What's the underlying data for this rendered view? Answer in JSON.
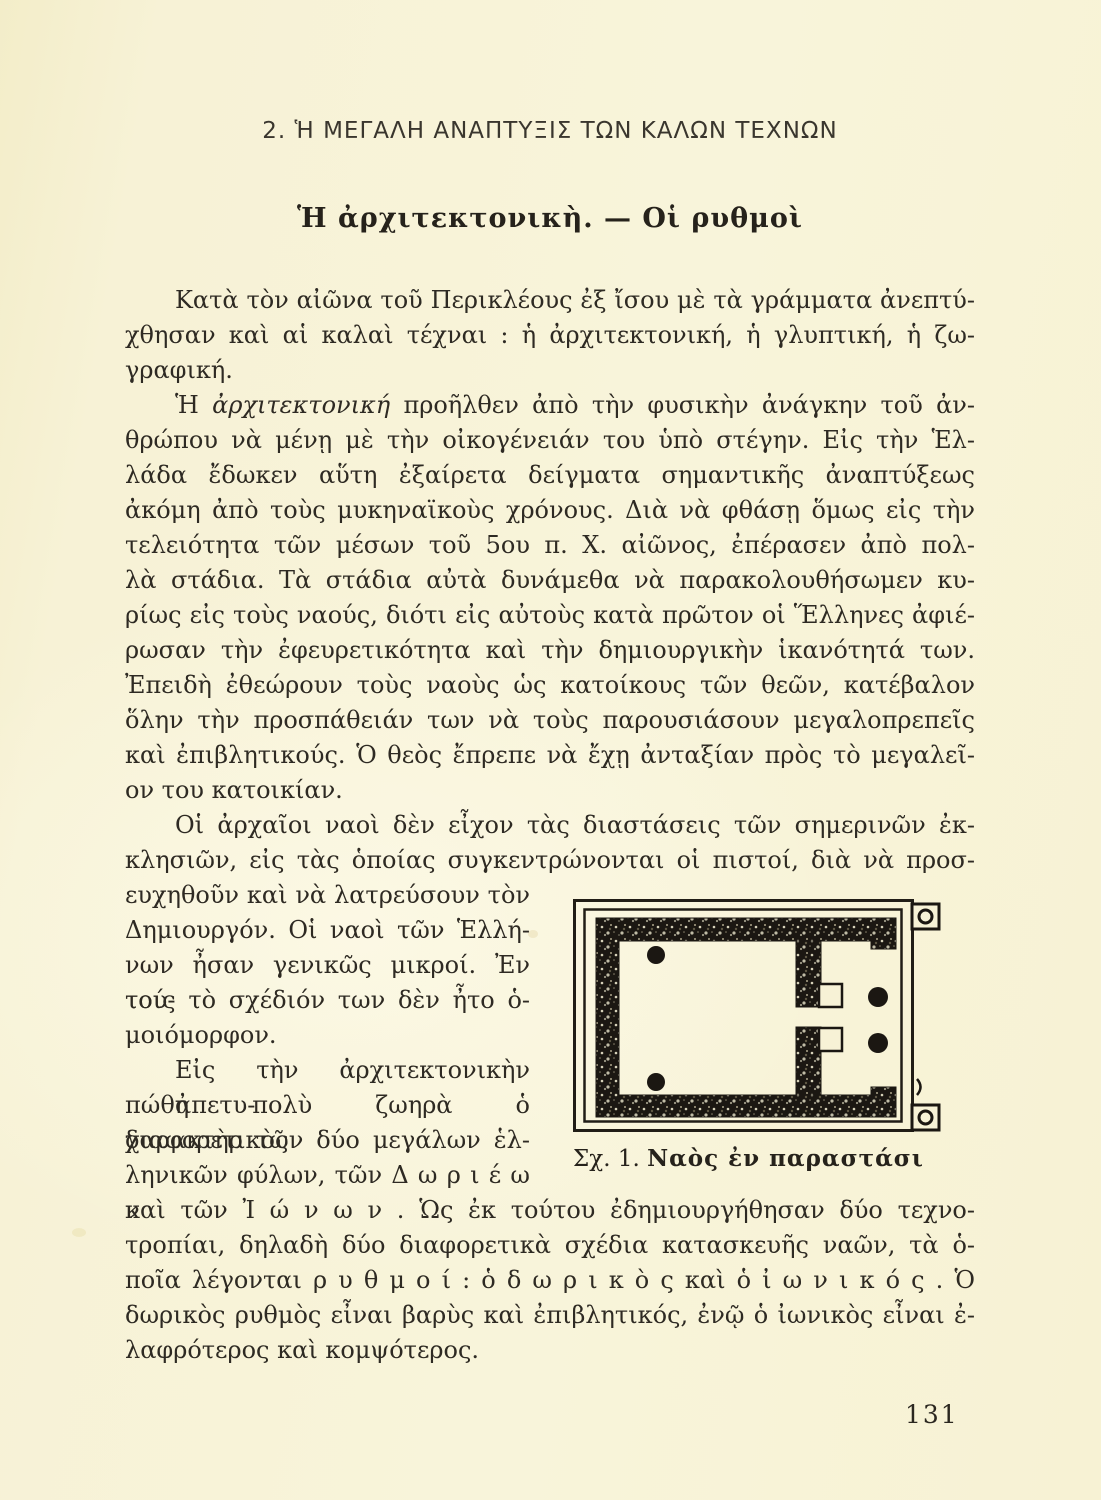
{
  "page": {
    "number": "131"
  },
  "colors": {
    "paper": "#f7f2d6",
    "ink": "#2e2a23",
    "figure_ink": "#1b1712"
  },
  "heading": {
    "section": "2. Ἡ ΜΕΓΑΛΗ ΑΝΑΠΤΥΞΙΣ ΤΩΝ ΚΑΛΩΝ ΤΕΧΝΩΝ",
    "title": "Ἡ ἀρχιτεκτονικὴ. — Οἱ ρυθμοὶ"
  },
  "body": {
    "p1": {
      "lines": [
        "Κατὰ τὸν αἰῶνα τοῦ Περικλέους ἐξ ἴσου μὲ τὰ γράμματα ἀνεπτύ-",
        "χθησαν καὶ αἱ καλαὶ τέχναι : ἡ ἀρχιτεκτονική, ἡ γλυπτική, ἡ ζω-",
        "γραφική."
      ]
    },
    "p2": {
      "lead": "Ἡ ",
      "italic_word": "ἀρχιτεκτονική",
      "after": " προῆλθεν ἀπὸ τὴν φυσικὴν ἀνάγκην τοῦ ἀν-",
      "lines": [
        "θρώπου νὰ μένῃ μὲ τὴν οἰκογένειάν του ὑπὸ στέγην. Εἰς τὴν Ἑλ-",
        "λάδα ἔδωκεν αὕτη ἐξαίρετα δείγματα σημαντικῆς ἀναπτύξεως",
        "ἀκόμη ἀπὸ τοὺς μυκηναϊκοὺς χρόνους. Διὰ νὰ φθάσῃ ὅμως εἰς τὴν",
        "τελειότητα τῶν μέσων τοῦ 5ου π. Χ. αἰῶνος, ἐπέρασεν ἀπὸ πολ-",
        "λὰ στάδια. Τὰ στάδια αὐτὰ δυνάμεθα νὰ παρακολουθήσωμεν κυ-",
        "ρίως εἰς τοὺς ναούς, διότι εἰς αὐτοὺς κατὰ πρῶτον οἱ Ἕλληνες ἀφιέ-",
        "ρωσαν τὴν ἐφευρετικότητα καὶ τὴν δημιουργικὴν ἱκανότητά των.",
        "Ἐπειδὴ ἐθεώρουν τοὺς ναοὺς ὡς κατοίκους τῶν θεῶν, κατέβαλον",
        "ὅλην τὴν προσπάθειάν των νὰ τοὺς παρουσιάσουν μεγαλοπρεπεῖς",
        "καὶ ἐπιβλητικούς. Ὁ θεὸς ἔπρεπε νὰ ἔχῃ ἀνταξίαν πρὸς τὸ μεγαλεῖ-",
        "ον του κατοικίαν."
      ]
    },
    "p3": {
      "lines": [
        "Οἱ ἀρχαῖοι ναοὶ δὲν εἶχον τὰς διαστάσεις τῶν σημερινῶν ἐκ-",
        "κλησιῶν, εἰς τὰς ὁποίας συγκεντρώνονται οἱ πιστοί, διὰ νὰ προσ-",
        "ευχηθοῦν καὶ νὰ λατρεύσουν τὸν",
        "Δημιουργόν. Οἱ ναοὶ τῶν Ἑλλή-",
        "νων ἦσαν γενικῶς μικροί. Ἐν τού-",
        "τοις τὸ σχέδιόν των δὲν ἦτο ὁ-",
        "μοιόμορφον."
      ]
    },
    "p4": {
      "lines": [
        "Εἰς τὴν ἀρχιτεκτονικὴν ἀπετυ-",
        "πώθη πολὺ ζωηρὰ ὁ διαφορετικὸς",
        "χαρακτὴρ τῶν δύο μεγάλων ἑλ-",
        "ληνικῶν φύλων, τῶν Δ ω ρ ι έ ω ν",
        "καὶ τῶν Ἰ ώ ν ω ν . Ὡς ἐκ τούτου ἐδημιουργήθησαν δύο τεχνο-",
        "τροπίαι, δηλαδὴ δύο διαφορετικὰ σχέδια κατασκευῆς ναῶν, τὰ ὁ-",
        "ποῖα λέγονται ρ υ θ μ ο ί : ὁ δ ω ρ ι κ ὸ ς καὶ ὁ ἰ ω ν ι κ ό ς . Ὁ",
        "δωρικὸς ρυθμὸς εἶναι βαρὺς καὶ ἐπιβλητικός, ἐνῷ ὁ ἰωνικὸς εἶναι ἐ-",
        "λαφρότερος καὶ κομψότερος."
      ]
    }
  },
  "figure": {
    "caption_prefix": "Σχ. 1. ",
    "caption_title": "Ναὸς ἐν παραστάσι"
  }
}
